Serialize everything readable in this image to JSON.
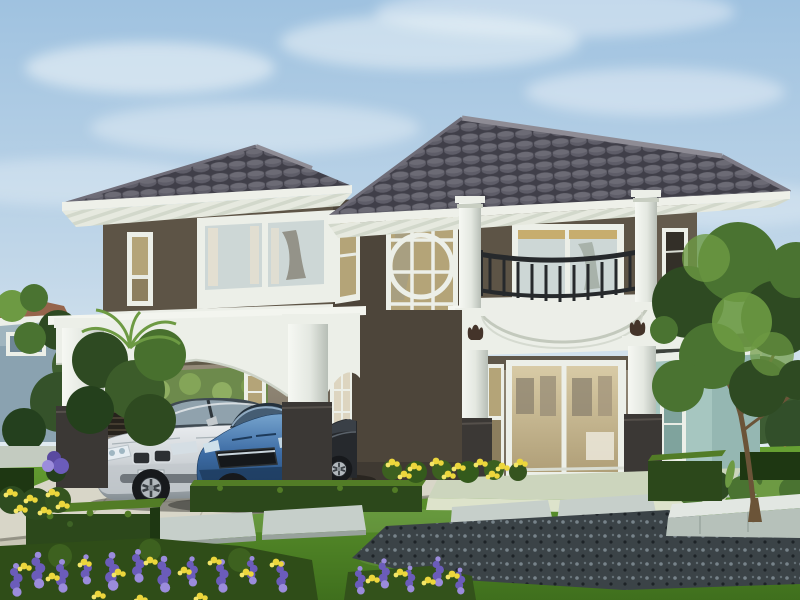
{
  "meta": {
    "domain": "natural-image",
    "subject": "3D architectural rendering of a modern two-story house exterior on a sunny day",
    "no_visible_text": true
  },
  "scene": {
    "sky": "clear light blue sky with soft white clouds",
    "house": {
      "stories": 2,
      "wall_finish": "dark taupe-brown stucco",
      "trim_finish": "white painted concrete",
      "roof": "dark grey concrete-tile hip roof with white fascia and striped soffit",
      "features": [
        "open carport with arched white beams and square columns on dark bases",
        "two-story glazed window wall with circular ring motif",
        "curved white balcony with dark wrought-metal railing",
        "round white porch columns",
        "sliding glass entry doors with sidelights",
        "dark tulip ornament emblems on white frieze",
        "corner picture window with curtains",
        "narrow accent windows",
        "pale teal single-story right wing"
      ]
    },
    "vehicles": [
      {
        "type": "silver luxury sedan",
        "position": "carport left"
      },
      {
        "type": "blue sports coupe",
        "position": "carport center"
      },
      {
        "type": "dark car partially hidden behind column",
        "position": "carport right"
      }
    ],
    "landscape": [
      "manicured green lawn",
      "trimmed rectangular box hedges",
      "stepping-stone path over dark pebble gravel",
      "stone planter bed with shrubs and ornamental tree",
      "purple and yellow flower bed in foreground",
      "yellow flowers at house base",
      "red flowering shrubs along rear boundary wall",
      "palm and shrubs beside carport",
      "concrete driveway with paving joints"
    ],
    "background": [
      "neighboring house with terracotta roof and blue-grey walls",
      "garden trees",
      "light boundary wall and rear walkway steps"
    ]
  },
  "colors": {
    "sky_top": "#9fc2e0",
    "sky_mid": "#c3d8e9",
    "sky_low": "#e4edf2",
    "cloud": "#f2f7fa",
    "roof_dark": "#403f49",
    "roof_mid": "#5e5d68",
    "roof_light": "#7d7c86",
    "roof_ridge": "#8e8c95",
    "fascia": "#eef0e9",
    "soffit": "#e6e9df",
    "soffit_stripe": "#d2d8cb",
    "trim": "#ecefe8",
    "trim_shadow": "#c8cec2",
    "wall": "#5d5446",
    "wall_dark": "#4d453a",
    "wall_light": "#6c6254",
    "glass_warm": "#b4a478",
    "glass_warm_dark": "#8c7e5e",
    "glass_cool": "#cdd7d6",
    "glass_dark": "#332f28",
    "railing": "#26292c",
    "emblem": "#44342a",
    "teal_wall": "#a6c6c0",
    "teal_dark": "#86aca6",
    "wing_fascia": "#3e433d",
    "base_dark": "#3b3835",
    "interior": "#a09685",
    "interior_dark": "#5f574a",
    "porch_slab": "#ccd5bd",
    "porch_face": "#dde3cb",
    "drive": "#d8d6c8",
    "drive_dark": "#c9c6b6",
    "curb": "#8b887c",
    "slab": "#c6cfca",
    "slab_edge": "#98a29c",
    "gravel": "#3b4347",
    "gravel_dot_light": "#77838a",
    "gravel_dot_dark": "#1d2327",
    "lawn": "#67a133",
    "lawn_dark": "#3f6f1d",
    "hedge": "#2c481b",
    "hedge_dark": "#1e3712",
    "hedge_light": "#527c26",
    "foliage_dark": "#2e4a22",
    "foliage_mid": "#4a7331",
    "foliage_light": "#6d9a43",
    "trunk": "#6b5438",
    "flower_purple": "#6b5cba",
    "flower_purple_light": "#9b8cdc",
    "flower_yellow": "#ecd63c",
    "flower_red": "#b23434",
    "car_silver": "#cdd2d6",
    "car_silver_dark": "#848d93",
    "car_glass": "#46505a",
    "car_blue": "#3c6ba4",
    "car_blue_light": "#78a6cf",
    "car_blue_dark": "#1e3e61",
    "car_dark": "#26292d",
    "wheel_dark": "#17191c",
    "wheel_rim": "#b9c0c5",
    "neighbor_roof": "#96654c",
    "neighbor_wall": "#8aa2b0",
    "bg_wall": "#a9b6a9"
  }
}
